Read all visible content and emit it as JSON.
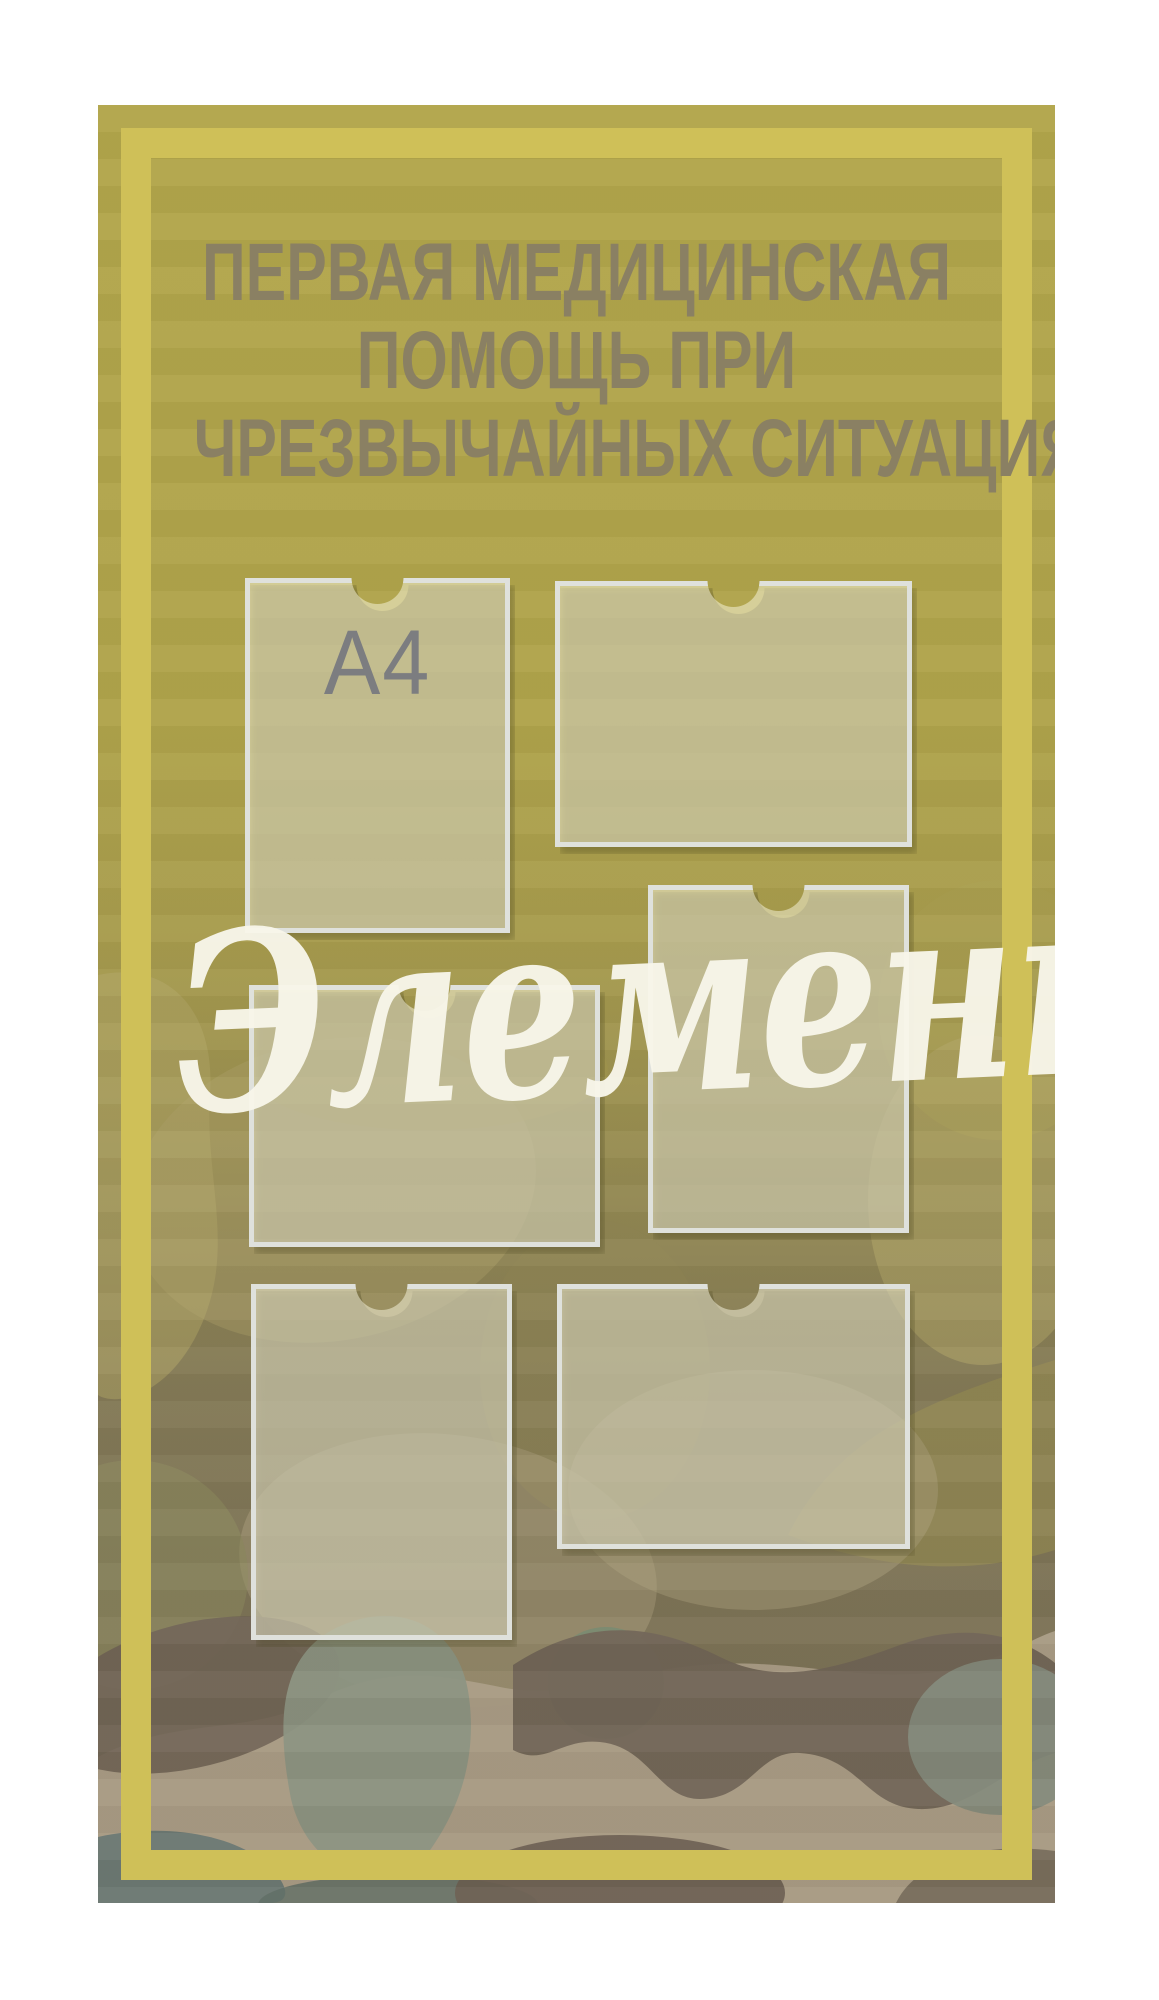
{
  "stand": {
    "title_lines": [
      "ПЕРВАЯ МЕДИЦИНСКАЯ",
      "ПОМОЩЬ ПРИ",
      "ЧРЕЗВЫЧАЙНЫХ СИТУАЦИЯХ"
    ],
    "watermark": "Элемент"
  },
  "pockets": [
    {
      "name": "pocket-1-a4-portrait",
      "orientation": "portrait",
      "label": "A4"
    },
    {
      "name": "pocket-2-a4-landscape",
      "orientation": "landscape",
      "label": ""
    },
    {
      "name": "pocket-3-a4-portrait",
      "orientation": "portrait",
      "label": ""
    },
    {
      "name": "pocket-4-a4-landscape",
      "orientation": "landscape",
      "label": ""
    },
    {
      "name": "pocket-5-a4-portrait",
      "orientation": "portrait",
      "label": ""
    },
    {
      "name": "pocket-6-a4-landscape",
      "orientation": "landscape",
      "label": ""
    }
  ],
  "colors": {
    "page_background": "#ffffff",
    "board_olive_top": "#b2a64b",
    "frame_stripe_yellow": "#cfc058",
    "title_text": "#8a8063",
    "a4_label_text": "#7c7d80",
    "pocket_border": "#dfe1dc",
    "pocket_film": "rgba(250,248,226,0.5)",
    "watermark_white": "#f8f6ea",
    "camo_tan": "#a99c85",
    "camo_brown": "#6f6455",
    "camo_sage": "#8a9180",
    "camo_slate": "#687671"
  }
}
